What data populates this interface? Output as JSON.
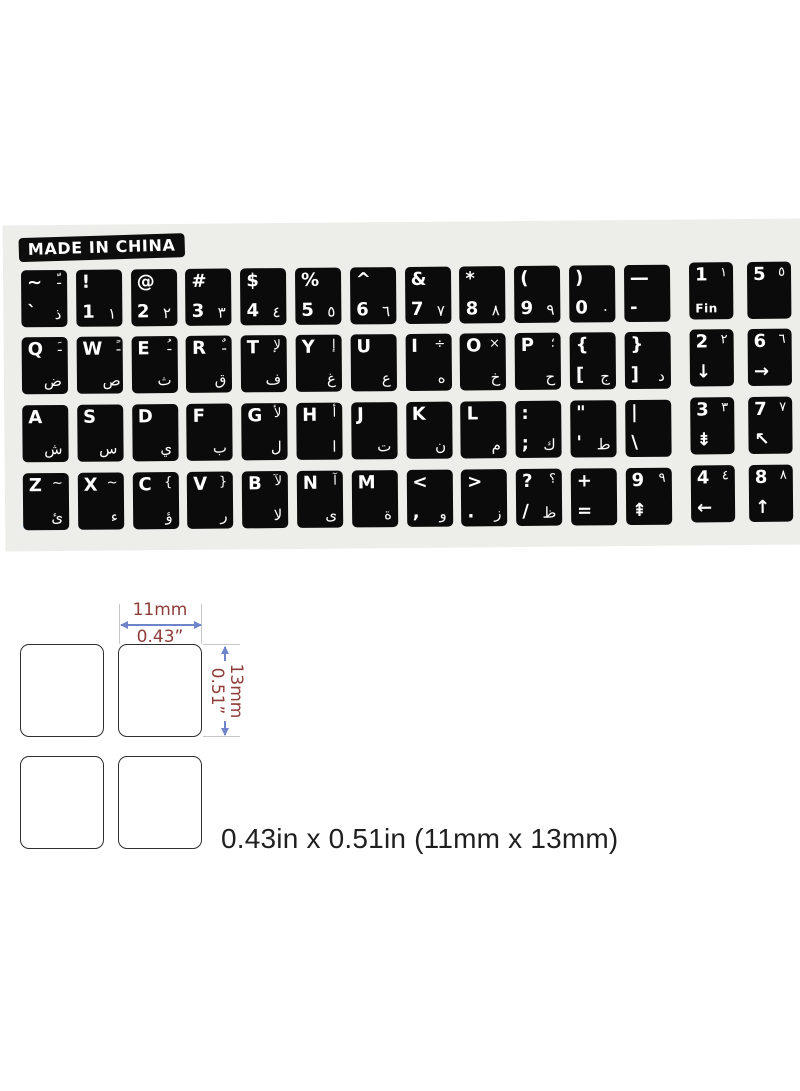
{
  "sheet": {
    "made_in_china": "MADE IN CHINA"
  },
  "keyboard": {
    "rows": [
      {
        "main": [
          {
            "tl": "~",
            "tr": "ـّ",
            "bl": "`",
            "br": "ذ"
          },
          {
            "tl": "!",
            "bl": "1",
            "br": "١"
          },
          {
            "tl": "@",
            "bl": "2",
            "br": "٢"
          },
          {
            "tl": "#",
            "bl": "3",
            "br": "٣"
          },
          {
            "tl": "$",
            "bl": "4",
            "br": "٤"
          },
          {
            "tl": "%",
            "bl": "5",
            "br": "٥"
          },
          {
            "tl": "^",
            "bl": "6",
            "br": "٦"
          },
          {
            "tl": "&",
            "bl": "7",
            "br": "٧"
          },
          {
            "tl": "*",
            "bl": "8",
            "br": "٨"
          },
          {
            "tl": "(",
            "bl": "9",
            "br": "٩"
          },
          {
            "tl": ")",
            "bl": "0",
            "br": "٠"
          },
          {
            "tl": "—",
            "bl": "-",
            "dash": true
          }
        ],
        "nav": [
          {
            "tl": "1",
            "tr": "١",
            "bl": "Fin"
          },
          {
            "tl": "5",
            "tr": "٥"
          }
        ]
      },
      {
        "main": [
          {
            "tl": "Q",
            "tr": "ـَ",
            "br": "ض"
          },
          {
            "tl": "W",
            "tr": "ـً",
            "br": "ص"
          },
          {
            "tl": "E",
            "tr": "ـُ",
            "br": "ث"
          },
          {
            "tl": "R",
            "tr": "ـٌ",
            "br": "ق"
          },
          {
            "tl": "T",
            "tr": "لإ",
            "br": "ف"
          },
          {
            "tl": "Y",
            "tr": "إ",
            "br": "غ"
          },
          {
            "tl": "U",
            "br": "ع"
          },
          {
            "tl": "I",
            "tr": "÷",
            "br": "ه"
          },
          {
            "tl": "O",
            "tr": "×",
            "br": "خ"
          },
          {
            "tl": "P",
            "tr": "؛",
            "br": "ح"
          },
          {
            "tl": "{",
            "bl": "[",
            "br": "ج"
          },
          {
            "tl": "}",
            "bl": "]",
            "br": "د"
          }
        ],
        "nav": [
          {
            "tl": "2",
            "tr": "٢",
            "bl": "↓"
          },
          {
            "tl": "6",
            "tr": "٦",
            "bl": "→"
          }
        ]
      },
      {
        "main": [
          {
            "tl": "A",
            "br": "ش"
          },
          {
            "tl": "S",
            "br": "س"
          },
          {
            "tl": "D",
            "br": "ي"
          },
          {
            "tl": "F",
            "br": "ب"
          },
          {
            "tl": "G",
            "tr": "لأ",
            "br": "ل"
          },
          {
            "tl": "H",
            "tr": "أ",
            "br": "ا"
          },
          {
            "tl": "J",
            "br": "ت"
          },
          {
            "tl": "K",
            "br": "ن"
          },
          {
            "tl": "L",
            "br": "م"
          },
          {
            "tl": ":",
            "bl": ";",
            "br": "ك"
          },
          {
            "tl": "\"",
            "bl": "'",
            "br": "ط"
          },
          {
            "tl": "|",
            "bl": "\\"
          }
        ],
        "nav": [
          {
            "tl": "3",
            "tr": "٣",
            "bl": "⇟"
          },
          {
            "tl": "7",
            "tr": "٧",
            "bl": "↖"
          }
        ]
      },
      {
        "main": [
          {
            "tl": "Z",
            "tr": "~",
            "br": "ئ"
          },
          {
            "tl": "X",
            "tr": "~",
            "br": "ء"
          },
          {
            "tl": "C",
            "tr": "{",
            "br": "ؤ"
          },
          {
            "tl": "V",
            "tr": "}",
            "br": "ر"
          },
          {
            "tl": "B",
            "tr": "لآ",
            "br": "لا"
          },
          {
            "tl": "N",
            "tr": "آ",
            "br": "ى"
          },
          {
            "tl": "M",
            "br": "ة"
          },
          {
            "tl": "<",
            "bl": ",",
            "br": "و"
          },
          {
            "tl": ">",
            "bl": ".",
            "br": "ز"
          },
          {
            "tl": "?",
            "tr": "؟",
            "bl": "/",
            "br": "ظ"
          },
          {
            "tl": "+",
            "bl": "="
          },
          {
            "tl": "9",
            "tr": "٩",
            "bl": "⇞"
          }
        ],
        "nav": [
          {
            "tl": "4",
            "tr": "٤",
            "bl": "←"
          },
          {
            "tl": "8",
            "tr": "٨",
            "bl": "↑"
          }
        ]
      }
    ]
  },
  "diagram": {
    "width_mm": "11mm",
    "width_in": "0.43”",
    "height_mm": "13mm",
    "height_in": "0.51”",
    "caption": "0.43in x 0.51in (11mm x 13mm)"
  },
  "colors": {
    "key_bg": "#0b0b0b",
    "key_text": "#ffffff",
    "sheet_bg": "#ededea",
    "dimension_text": "#8e3d38",
    "arrow_blue": "#6e86c9",
    "extension_gray": "#c6c6c3",
    "caption_text": "#1f1f1f"
  }
}
